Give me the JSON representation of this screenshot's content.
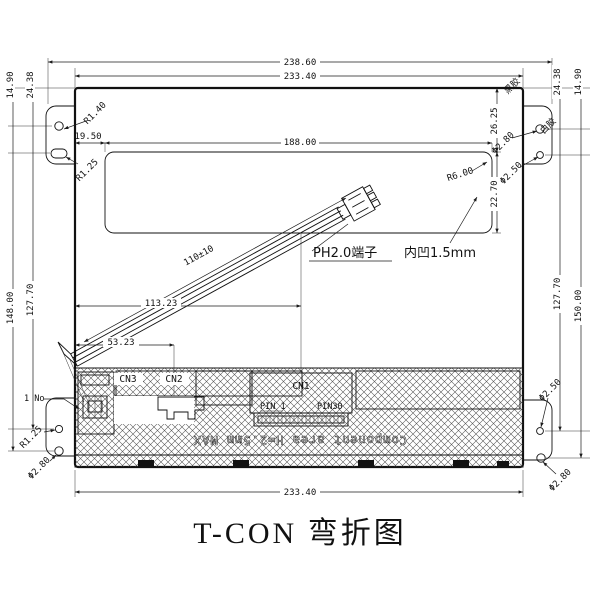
{
  "title": "T-CON 弯折图",
  "colors": {
    "line": "#111111",
    "background": "#ffffff"
  },
  "dims": {
    "top_outer": "238.60",
    "top_inner": "233.40",
    "bottom": "233.40",
    "win_offset": "19.50",
    "win_width": "188.00",
    "win_top": "26.25",
    "win_height": "22.70",
    "left_a": "14.90",
    "left_b": "24.38",
    "left_c": "148.00",
    "left_d": "127.70",
    "right_a": "24.38",
    "right_b": "14.90",
    "right_c": "127.70",
    "right_d": "150.00",
    "cable_len": "110±10",
    "cn1_pos": "113.23",
    "cn2_pos": "53.23",
    "hole_r_tl": "R1.40",
    "slot_r_tl": "R1.25",
    "hole_d_tr_a": "Φ2.80",
    "hole_d_tr_b": "Φ2.50",
    "hole_r_bl": "R1.25",
    "hole_d_bl": "Φ2.80",
    "hole_d_br_a": "Φ2.50",
    "hole_d_br_b": "Φ2.80",
    "corner_r": "R6.00"
  },
  "labels": {
    "black_glue": "黑胶",
    "white_glue": "白胶",
    "connector_note": "PH2.0端子",
    "recess_note": "内凹1.5mm",
    "pin1_note": "1 No",
    "cn1": "CN1",
    "cn2": "CN2",
    "cn3": "CN3",
    "pin1": "PIN 1",
    "pin30": "PIN30",
    "component_area": "Component area H=2.5mm MAX"
  }
}
